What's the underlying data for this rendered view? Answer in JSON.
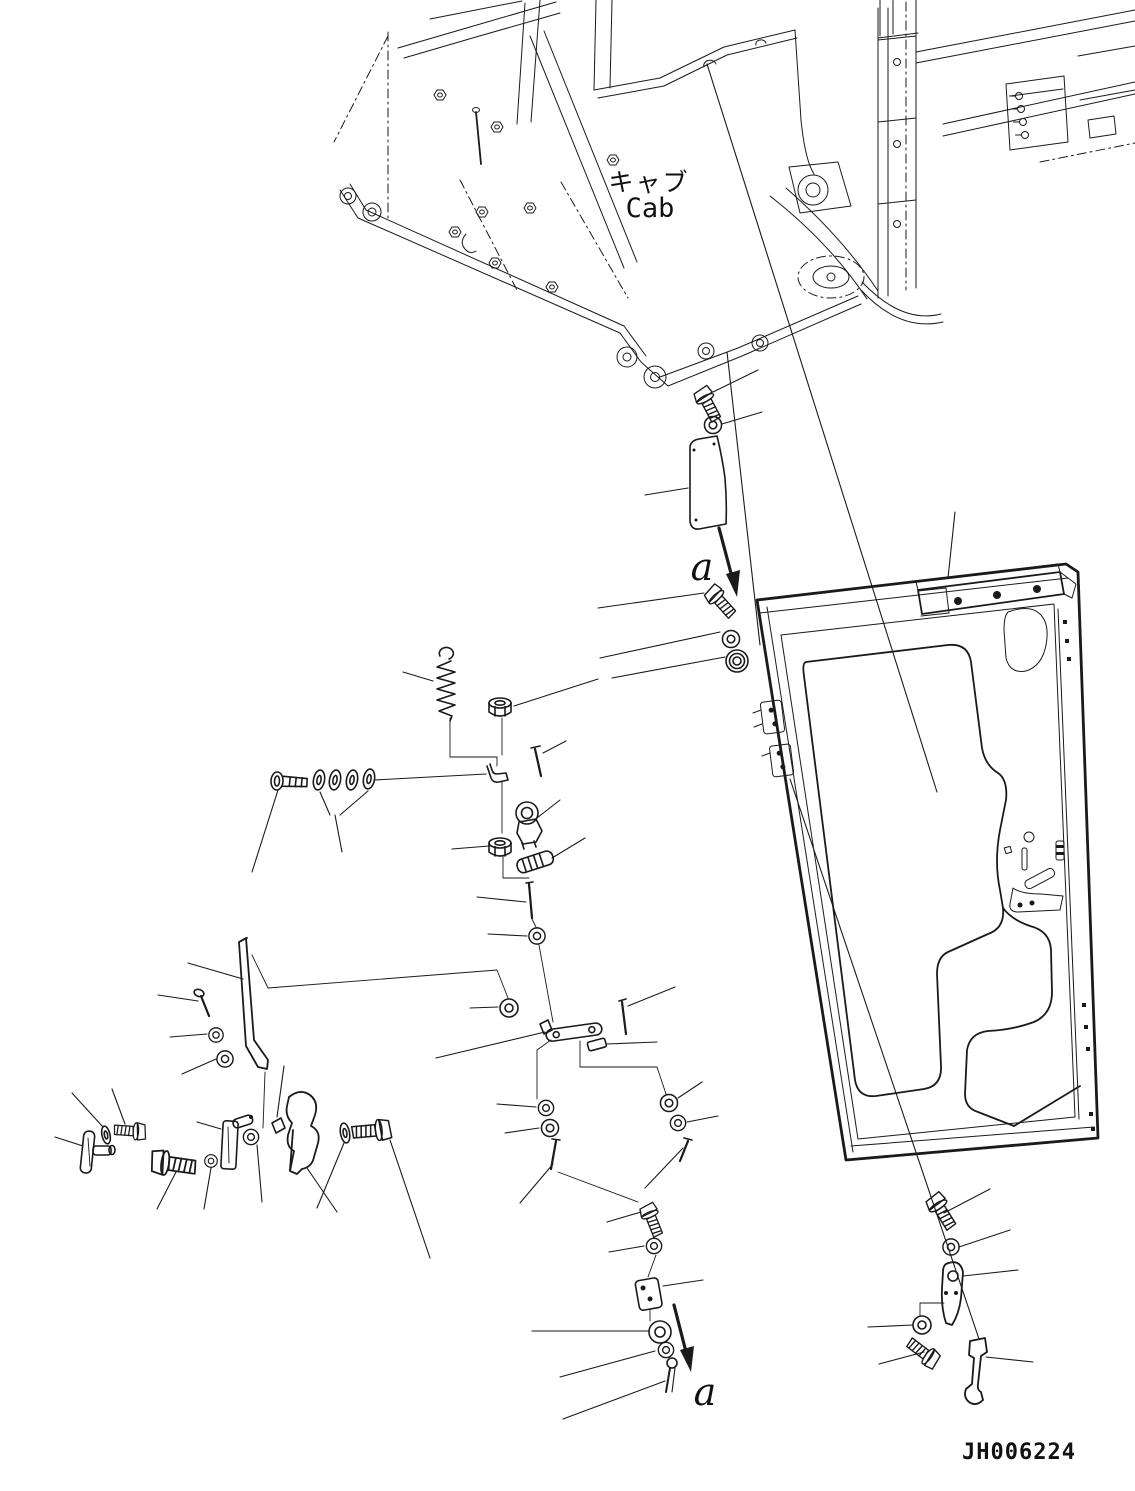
{
  "diagram": {
    "title_jp": "キャブ",
    "title_en": "Cab",
    "drawing_number": "JH006224",
    "section_arrows": [
      {
        "label": "a",
        "position": "upper"
      },
      {
        "label": "a",
        "position": "lower"
      }
    ],
    "colors": {
      "line": "#1a1a1a",
      "background": "#ffffff"
    }
  },
  "icons": [
    "cab-frame-drawing",
    "cab-door-drawing",
    "door-window-cutout",
    "door-top-rail",
    "door-hinge-icon",
    "door-latch-icon",
    "bolt-icon",
    "round-head-bolt-icon",
    "washer-icon",
    "hex-nut-icon",
    "spring-icon",
    "pin-icon",
    "cotter-pin-icon",
    "door-check-rod-icon",
    "link-icon",
    "bracket-icon",
    "striker-icon",
    "hinge-arm-icon",
    "hook-latch-icon",
    "shield-plate-icon",
    "knurled-sleeve-icon",
    "ball-stud-icon",
    "clip-icon",
    "leader-line",
    "witness-line",
    "section-arrow"
  ]
}
